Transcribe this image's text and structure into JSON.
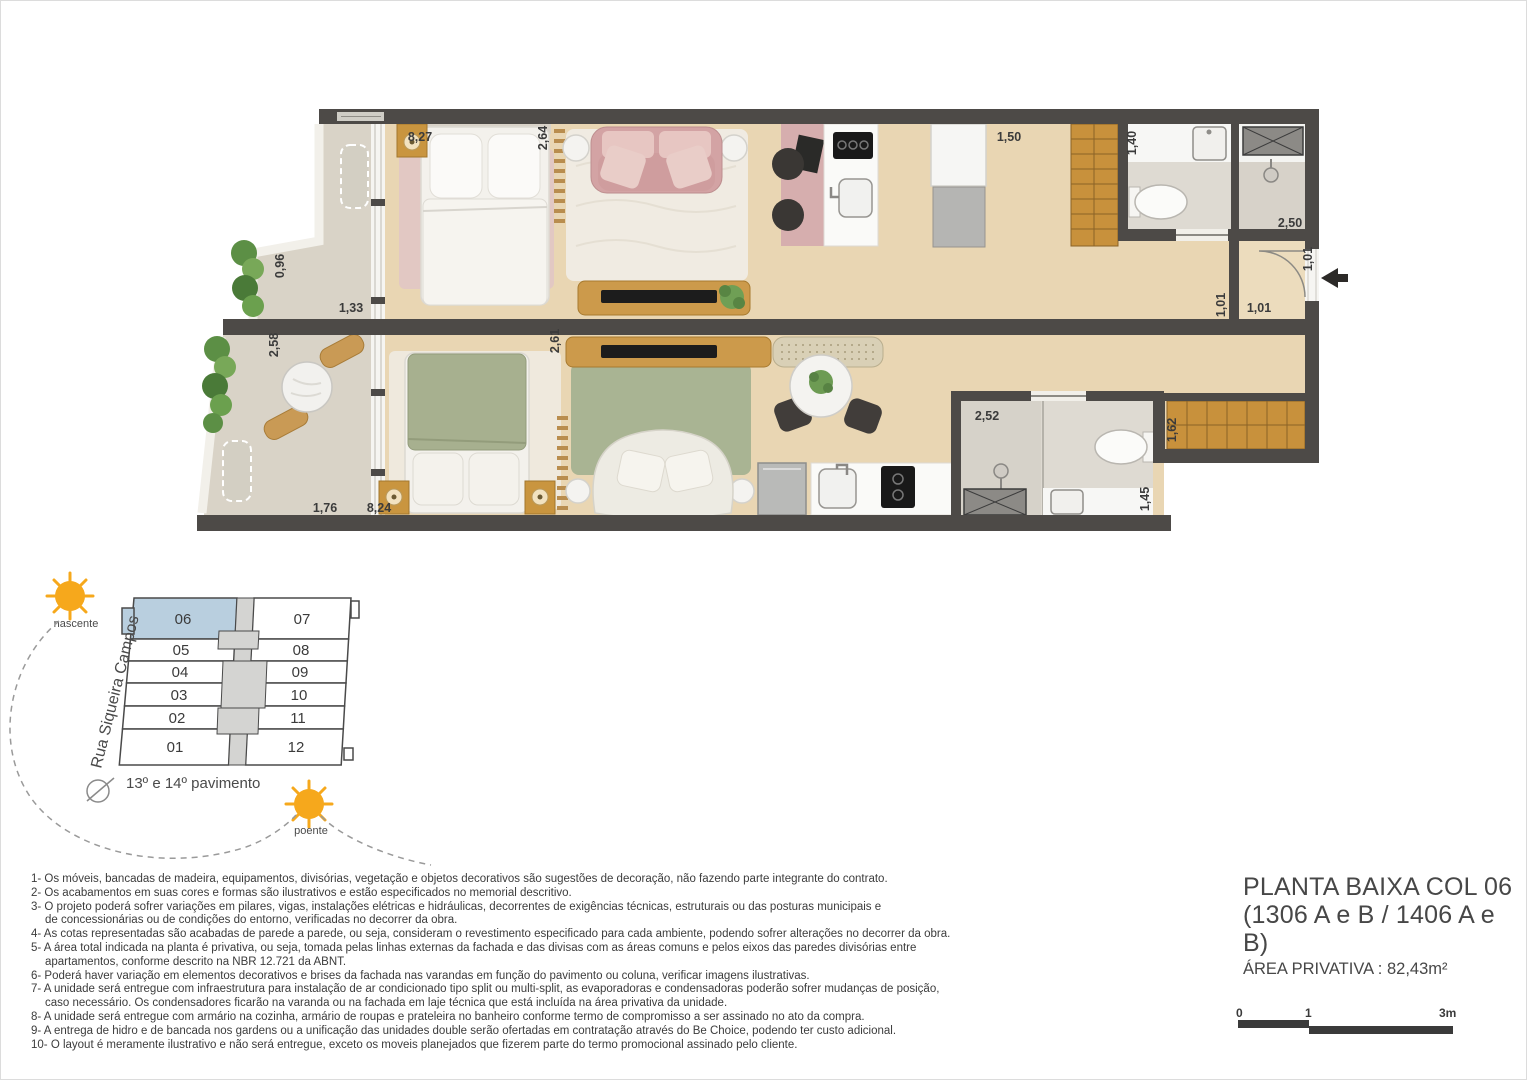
{
  "colors": {
    "wall": "#4d4a47",
    "wood_floor": "#e9d6b3",
    "balcony_floor": "#d9d3c7",
    "bathroom_tile": "#dedad2",
    "keyplan_highlight": "#b9cfdf",
    "sun": "#f6a81c",
    "accent_pink": "#d5a5a6",
    "accent_green": "#a9b493"
  },
  "floor_plan": {
    "dims": {
      "a_width": "8,27",
      "a_bedroom_depth": "2,64",
      "a_hall": "1,50",
      "a_bath": "1,40",
      "a_shower": "2,50",
      "entry_side": "1,01",
      "entry_inner": "1,01",
      "entry_width": "1,01",
      "a_balcony_w": "0,96",
      "a_balcony_l": "1,33",
      "b_balcony_d": "2,58",
      "b_balcony_w": "1,76",
      "b_width": "8,24",
      "b_bedroom_depth": "2,61",
      "b_bath_w": "2,52",
      "b_bath_d": "1,45",
      "b_wardrobe": "1,62"
    }
  },
  "key_plan": {
    "street": "Rua Siqueira Campos",
    "floor": "13º e 14º pavimento",
    "sun_east": "nascente",
    "sun_west": "poente",
    "highlighted": "06",
    "units_left": [
      "06",
      "05",
      "04",
      "03",
      "02",
      "01"
    ],
    "units_right": [
      "07",
      "08",
      "09",
      "10",
      "11",
      "12"
    ]
  },
  "notes": {
    "lines": [
      "1- Os móveis, bancadas de madeira, equipamentos, divisórias, vegetação e objetos decorativos são sugestões de decoração, não fazendo parte integrante do contrato.",
      "2- Os acabamentos em suas cores e formas são ilustrativos e estão especificados no memorial descritivo.",
      "3- O projeto poderá sofrer variações em pilares, vigas, instalações elétricas e hidráulicas, decorrentes de exigências técnicas, estruturais ou das posturas municipais e",
      "de concessionárias ou de condições do entorno, verificadas no decorrer da obra.",
      "4- As cotas representadas são acabadas de parede a parede, ou seja, consideram o revestimento especificado para cada ambiente, podendo sofrer alterações no decorrer da obra.",
      "5- A área total indicada na planta é privativa, ou seja, tomada pelas linhas externas da fachada e das divisas com as áreas comuns e pelos eixos das paredes divisórias entre",
      "apartamentos, conforme descrito na NBR 12.721 da ABNT.",
      "6- Poderá haver variação em elementos decorativos e brises da fachada nas varandas em função do pavimento ou coluna, verificar imagens ilustrativas.",
      "7- A unidade será entregue com infraestrutura para instalação de ar condicionado tipo split ou multi-split, as evaporadoras e condensadoras poderão sofrer mudanças de posição,",
      "caso necessário. Os condensadores ficarão na varanda ou na fachada em laje técnica que está incluída na área privativa da unidade.",
      "8- A unidade será entregue com armário na cozinha, armário de roupas e prateleira no banheiro conforme termo de compromisso a ser assinado no ato da compra.",
      "9- A entrega de hidro e de bancada nos gardens ou a unificação das unidades double serão ofertadas em contratação através do Be Choice, podendo ter custo adicional.",
      "10- O layout é meramente ilustrativo e não será entregue, exceto os moveis planejados que fizerem parte do termo promocional assinado pelo cliente."
    ]
  },
  "title_block": {
    "line1": "PLANTA BAIXA COL 06",
    "line2": "(1306 A e B / 1406 A e B)",
    "line3": "ÁREA PRIVATIVA : 82,43m²"
  },
  "scale_bar": {
    "zero": "0",
    "one": "1",
    "three": "3m"
  }
}
